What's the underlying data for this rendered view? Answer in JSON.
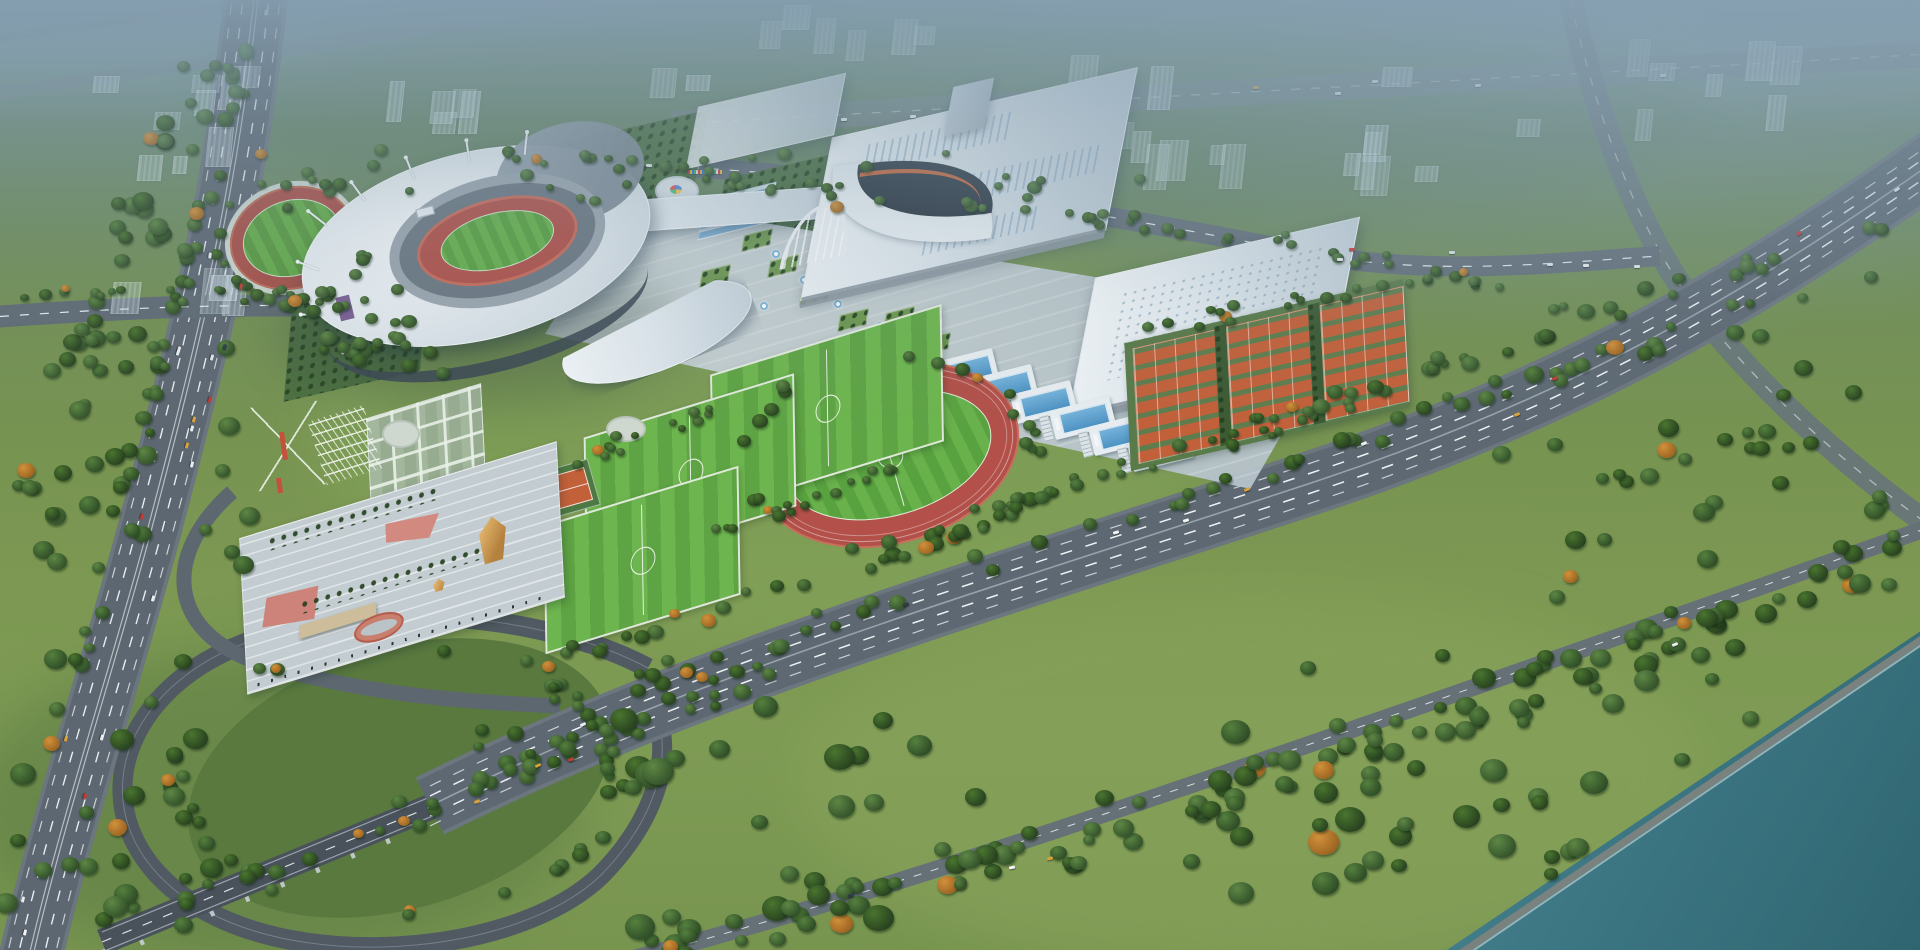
{
  "meta": {
    "kind": "architectural-aerial-rendering",
    "subject": "sports-complex-masterplan",
    "text_content": "none"
  },
  "palette": {
    "haze": "#87a0b2",
    "lawn": "#7a9751",
    "tree_dark": "#2e4c26",
    "tree_mid": "#4e7a38",
    "autumn": "#bd7a33",
    "asphalt": "#5a646e",
    "roof_white": "#eef2f5",
    "track_red": "#b05048",
    "pitch_green": "#63ab47",
    "clay_orange": "#c2603a",
    "pool_blue": "#5fa8d6",
    "river_teal": "#3f7f8a",
    "plaza": "#c6cfd3",
    "gold_roof": "#d9a75f",
    "facade_purple": "#6b4f86"
  },
  "scene": {
    "ghost_clusters": [
      [
        20,
        60,
        240,
        120,
        9
      ],
      [
        350,
        75,
        200,
        85,
        5
      ],
      [
        596,
        0,
        340,
        110,
        8
      ],
      [
        1020,
        25,
        300,
        165,
        11
      ],
      [
        1330,
        55,
        230,
        150,
        8
      ],
      [
        1620,
        35,
        280,
        105,
        7
      ],
      [
        96,
        240,
        150,
        95,
        4
      ]
    ],
    "tree_lines": [
      [
        500,
        682,
        1880,
        218,
        10,
        64,
        5,
        9
      ],
      [
        470,
        742,
        1870,
        266,
        12,
        56,
        5,
        9
      ],
      [
        640,
        946,
        1080,
        845,
        22,
        40,
        6,
        12
      ],
      [
        1080,
        845,
        1500,
        705,
        22,
        40,
        6,
        12
      ],
      [
        1500,
        705,
        1910,
        545,
        22,
        36,
        6,
        12
      ],
      [
        108,
        928,
        840,
        640,
        16,
        48,
        5,
        9
      ],
      [
        474,
        150,
        1290,
        240,
        8,
        40,
        4,
        7
      ],
      [
        1290,
        240,
        1590,
        310,
        8,
        16,
        4,
        7
      ],
      [
        246,
        40,
        70,
        700,
        10,
        40,
        5,
        9
      ],
      [
        200,
        60,
        10,
        560,
        26,
        40,
        6,
        11
      ],
      [
        10,
        292,
        440,
        296,
        8,
        22,
        4,
        7
      ],
      [
        300,
        318,
        430,
        352,
        24,
        30,
        5,
        8
      ],
      [
        560,
        470,
        720,
        404,
        8,
        14,
        4,
        6
      ],
      [
        700,
        540,
        900,
        470,
        8,
        16,
        4,
        6
      ],
      [
        960,
        512,
        1380,
        398,
        8,
        22,
        4,
        7
      ],
      [
        1140,
        330,
        1430,
        278,
        8,
        18,
        4,
        7
      ]
    ],
    "tree_rects": [
      [
        620,
        700,
        760,
        230,
        32,
        8,
        16
      ],
      [
        0,
        640,
        230,
        300,
        26,
        7,
        13
      ],
      [
        40,
        330,
        210,
        250,
        22,
        6,
        11
      ],
      [
        1430,
        330,
        460,
        170,
        18,
        6,
        10
      ],
      [
        260,
        150,
        900,
        60,
        30,
        4,
        8
      ],
      [
        1300,
        640,
        520,
        260,
        44,
        7,
        14
      ],
      [
        1520,
        420,
        380,
        180,
        20,
        6,
        11
      ]
    ],
    "tree_rings": [
      [
        400,
        778,
        225,
        135,
        40,
        5,
        9
      ],
      [
        292,
        240,
        78,
        60,
        18,
        4,
        7
      ],
      [
        889,
        455,
        146,
        100,
        26,
        5,
        8
      ]
    ],
    "car_routes": [
      {
        "pts": [
          [
            252,
            0
          ],
          [
            215,
            290
          ],
          [
            150,
            520
          ],
          [
            62,
            820
          ],
          [
            30,
            950
          ]
        ],
        "n": 20,
        "lanes": [
          -22,
          -12,
          12,
          22
        ]
      },
      {
        "pts": [
          [
            440,
            800
          ],
          [
            800,
            640
          ],
          [
            1200,
            520
          ],
          [
            1560,
            380
          ],
          [
            1920,
            165
          ]
        ],
        "n": 13,
        "lanes": [
          -14,
          -6,
          6,
          14
        ]
      },
      {
        "pts": [
          [
            480,
            162
          ],
          [
            900,
            180
          ],
          [
            1300,
            252
          ],
          [
            1640,
            260
          ]
        ],
        "n": 7,
        "lanes": [
          -5,
          5
        ]
      },
      {
        "pts": [
          [
            660,
            942
          ],
          [
            1080,
            845
          ],
          [
            1500,
            705
          ],
          [
            1880,
            558
          ]
        ],
        "n": 4,
        "lanes": [
          -4,
          4
        ]
      },
      {
        "pts": [
          [
            680,
            122
          ],
          [
            1900,
            56
          ]
        ],
        "n": 7,
        "lanes": [
          -5,
          5
        ]
      }
    ],
    "car_colors": [
      "#e8edf0",
      "#e8edf0",
      "#dfe5e9",
      "#c23b35",
      "#2e3c48",
      "#d9a23a",
      "#f2f5f7"
    ],
    "pool_units": 6,
    "tennis_blocks": 3,
    "soccer_fields": 3,
    "flag_colors": [
      "#e23b3b",
      "#f5c53a",
      "#3a7de2",
      "#3ac06a",
      "#f2f2f2",
      "#e23b3b",
      "#3a7de2",
      "#f5c53a"
    ],
    "fountains": [
      [
        772,
        250
      ],
      [
        800,
        276
      ],
      [
        834,
        300
      ],
      [
        760,
        302
      ],
      [
        876,
        322
      ]
    ],
    "plaza_beds": [
      [
        742,
        232
      ],
      [
        768,
        258
      ],
      [
        800,
        286
      ],
      [
        838,
        312
      ],
      [
        700,
        268
      ],
      [
        884,
        310
      ],
      [
        920,
        336
      ]
    ]
  }
}
